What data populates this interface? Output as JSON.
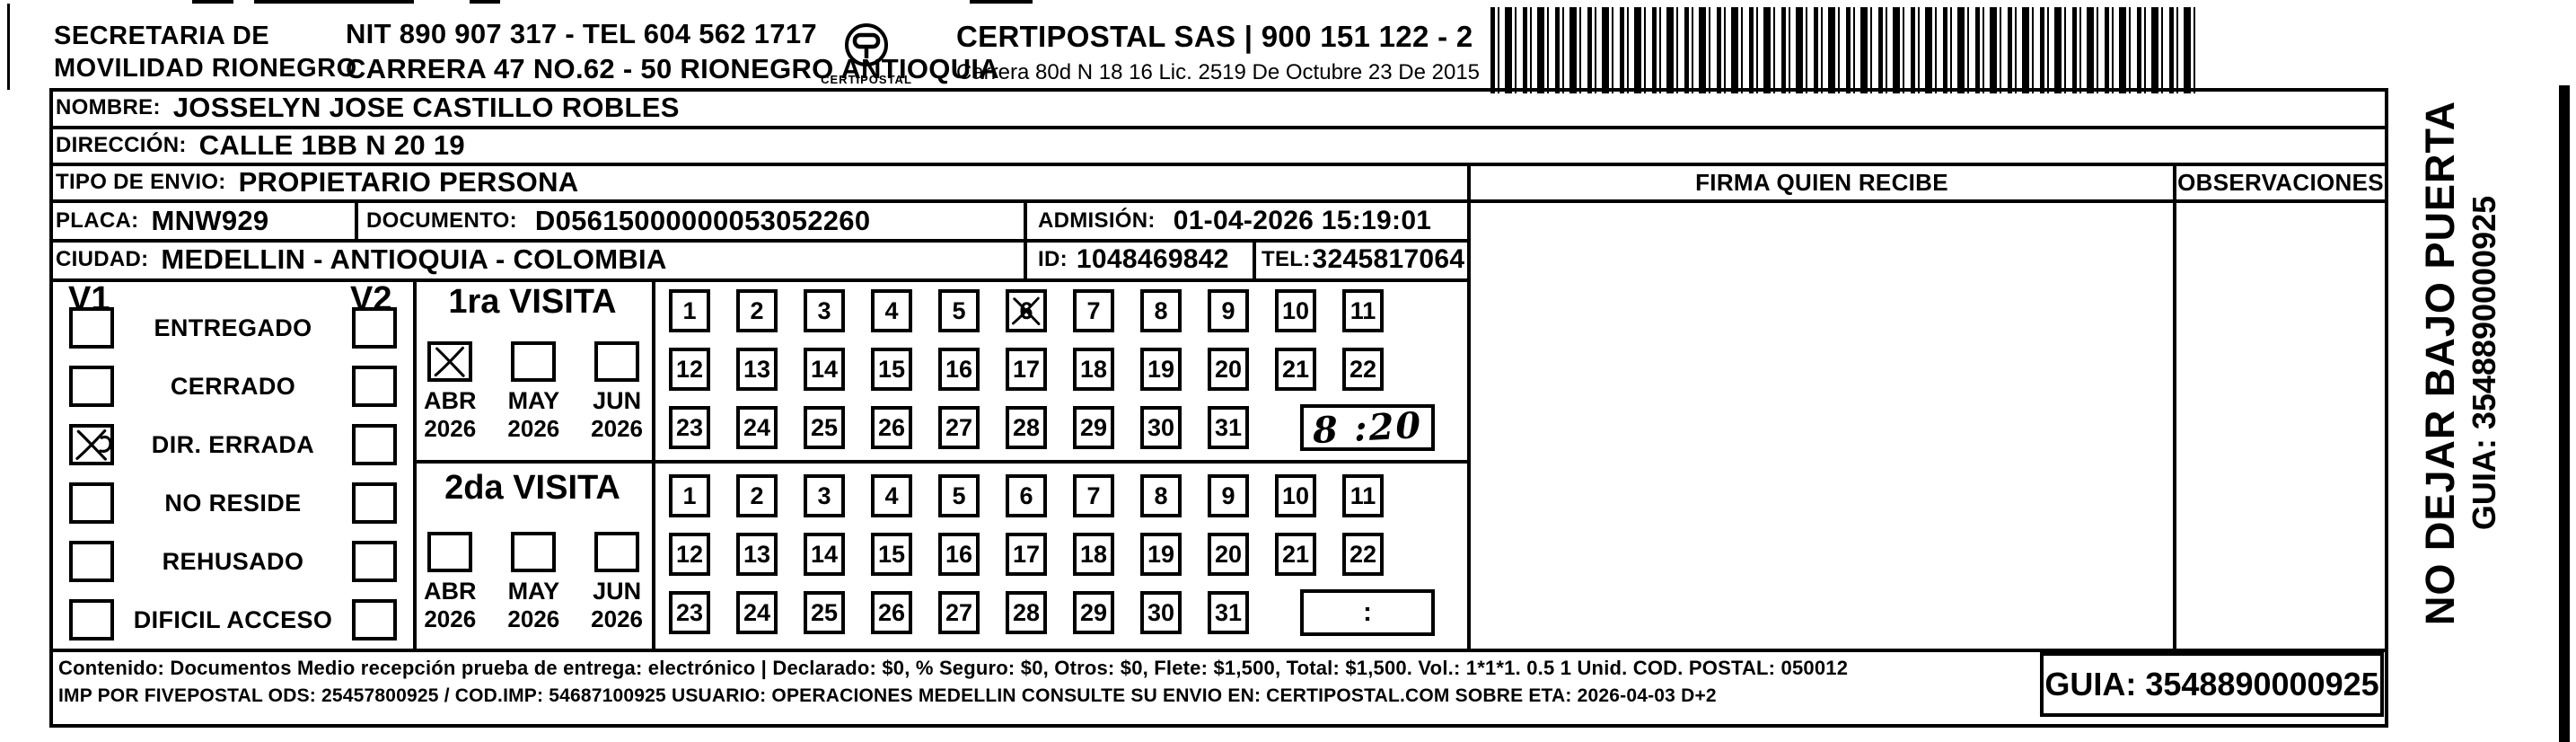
{
  "colors": {
    "ink": "#000000",
    "paper": "#ffffff"
  },
  "header": {
    "org_line1": "SECRETARIA  DE",
    "org_line2": "MOVILIDAD RIONEGRO",
    "nit_line": "NIT 890 907 317 - TEL 604 562 1717",
    "address_line": "CARRERA 47 NO.62 - 50 RIONEGRO ANTIOQUIA",
    "logo_text": "CERTIPOSTAL",
    "company_line1": "CERTIPOSTAL SAS | 900 151 122 - 2",
    "company_line2": "Carrera 80d N 18 16  Lic. 2519 De Octubre 23 De 2015"
  },
  "shipment": {
    "nombre_label": "NOMBRE:",
    "nombre": "JOSSELYN JOSE CASTILLO ROBLES",
    "direccion_label": "DIRECCIÓN:",
    "direccion": "CALLE 1BB N 20 19",
    "tipo_envio_label": "TIPO DE ENVIO:",
    "tipo_envio": "PROPIETARIO PERSONA",
    "placa_label": "PLACA:",
    "placa": "MNW929",
    "documento_label": "DOCUMENTO:",
    "documento": "D05615000000053052260",
    "admision_label": "ADMISIÓN:",
    "admision": "01-04-2026 15:19:01",
    "ciudad_label": "CIUDAD:",
    "ciudad": "MEDELLIN - ANTIOQUIA - COLOMBIA",
    "id_label": "ID:",
    "id_value": "1048469842",
    "tel_label": "TEL:",
    "tel_value": "3245817064"
  },
  "status": {
    "v1_header": "V1",
    "v2_header": "V2",
    "options": [
      {
        "label": "ENTREGADO",
        "v1_checked": false,
        "v2_checked": false
      },
      {
        "label": "CERRADO",
        "v1_checked": false,
        "v2_checked": false
      },
      {
        "label": "DIR. ERRADA",
        "v1_checked": true,
        "v2_checked": false,
        "mark_style": "x-loop"
      },
      {
        "label": "NO RESIDE",
        "v1_checked": false,
        "v2_checked": false
      },
      {
        "label": "REHUSADO",
        "v1_checked": false,
        "v2_checked": false
      },
      {
        "label": "DIFICIL ACCESO",
        "v1_checked": false,
        "v2_checked": false
      }
    ]
  },
  "visits": [
    {
      "title": "1ra VISITA",
      "months": [
        {
          "label": "ABR",
          "year": "2026",
          "checked": true
        },
        {
          "label": "MAY",
          "year": "2026",
          "checked": false
        },
        {
          "label": "JUN",
          "year": "2026",
          "checked": false
        }
      ],
      "day_rows": [
        [
          1,
          2,
          3,
          4,
          5,
          6,
          7,
          8,
          9,
          10,
          11
        ],
        [
          12,
          13,
          14,
          15,
          16,
          17,
          18,
          19,
          20,
          21,
          22
        ],
        [
          23,
          24,
          25,
          26,
          27,
          28,
          29,
          30,
          31
        ]
      ],
      "crossed_days": [
        6
      ],
      "time": "8 :20",
      "time_handwritten": true
    },
    {
      "title": "2da VISITA",
      "months": [
        {
          "label": "ABR",
          "year": "2026",
          "checked": false
        },
        {
          "label": "MAY",
          "year": "2026",
          "checked": false
        },
        {
          "label": "JUN",
          "year": "2026",
          "checked": false
        }
      ],
      "day_rows": [
        [
          1,
          2,
          3,
          4,
          5,
          6,
          7,
          8,
          9,
          10,
          11
        ],
        [
          12,
          13,
          14,
          15,
          16,
          17,
          18,
          19,
          20,
          21,
          22
        ],
        [
          23,
          24,
          25,
          26,
          27,
          28,
          29,
          30,
          31
        ]
      ],
      "crossed_days": [],
      "time": ":",
      "time_handwritten": false
    }
  ],
  "signature": {
    "firma_header": "FIRMA QUIEN RECIBE",
    "observaciones_header": "OBSERVACIONES"
  },
  "side_note": {
    "line1": "NO DEJAR BAJO PUERTA",
    "line2": "GUIA: 3548890000925"
  },
  "footer": {
    "line1": "Contenido: Documentos Medio recepción prueba de entrega: electrónico | Declarado: $0, % Seguro: $0, Otros: $0, Flete: $1,500, Total: $1,500. Vol.: 1*1*1. 0.5  1 Unid. COD. POSTAL: 050012",
    "line2": "IMP POR FIVEPOSTAL ODS: 25457800925 / COD.IMP: 54687100925 USUARIO: OPERACIONES MEDELLIN CONSULTE SU ENVIO EN: CERTIPOSTAL.COM SOBRE ETA: 2026-04-03 D+2",
    "guia": "GUIA: 3548890000925"
  }
}
